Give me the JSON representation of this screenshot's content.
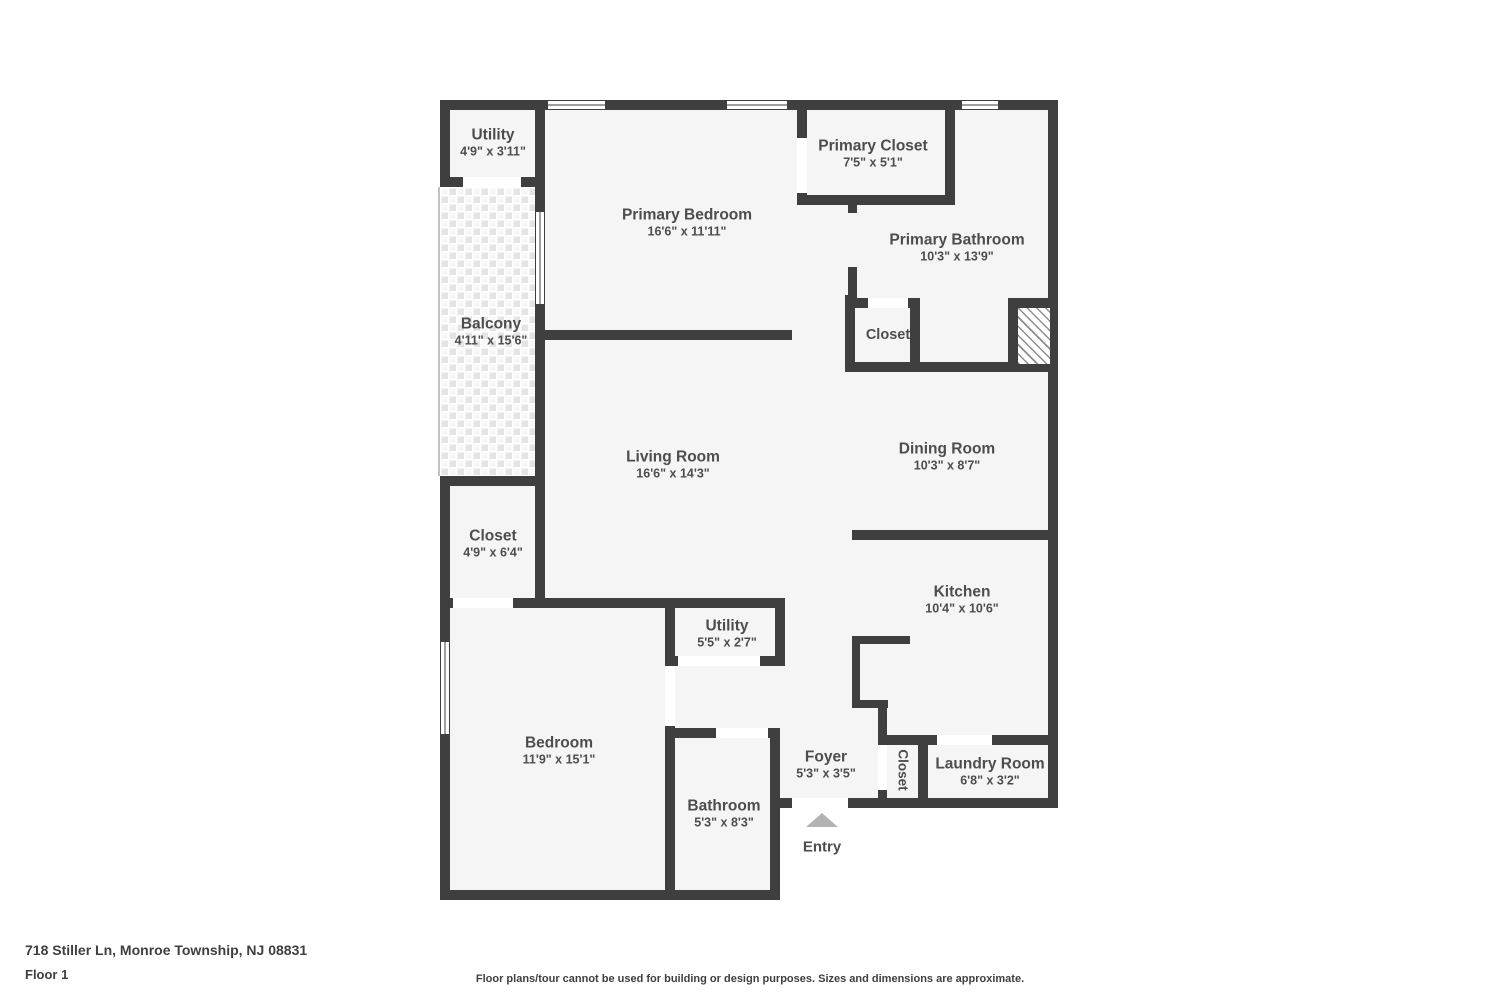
{
  "colors": {
    "wall": "#3f3f3f",
    "fill": "#f5f5f5",
    "text": "#4d4d4d",
    "arrow": "#b3b3b3"
  },
  "rooms": [
    {
      "name": "Utility",
      "dims": "4'9\" x 3'11\""
    },
    {
      "name": "Primary Bedroom",
      "dims": "16'6\" x 11'11\""
    },
    {
      "name": "Primary Closet",
      "dims": "7'5\" x 5'1\""
    },
    {
      "name": "Primary Bathroom",
      "dims": "10'3\" x 13'9\""
    },
    {
      "name": "Balcony",
      "dims": "4'11\" x 15'6\""
    },
    {
      "name": "Closet",
      "dims": ""
    },
    {
      "name": "Living Room",
      "dims": "16'6\" x 14'3\""
    },
    {
      "name": "Dining Room",
      "dims": "10'3\" x 8'7\""
    },
    {
      "name": "Closet",
      "dims": "4'9\" x 6'4\""
    },
    {
      "name": "Kitchen",
      "dims": "10'4\" x 10'6\""
    },
    {
      "name": "Bedroom",
      "dims": "11'9\" x 15'1\""
    },
    {
      "name": "Utility",
      "dims": "5'5\" x 2'7\""
    },
    {
      "name": "Bathroom",
      "dims": "5'3\" x 8'3\""
    },
    {
      "name": "Foyer",
      "dims": "5'3\" x 3'5\""
    },
    {
      "name": "Closet",
      "dims": ""
    },
    {
      "name": "Laundry Room",
      "dims": "6'8\" x 3'2\""
    }
  ],
  "entry": {
    "label": "Entry"
  },
  "footer": {
    "address": "718 Stiller Ln, Monroe Township, NJ 08831",
    "floor_label": "Floor 1",
    "disclaimer": "Floor plans/tour cannot be used for building or design purposes. Sizes and dimensions are approximate."
  }
}
